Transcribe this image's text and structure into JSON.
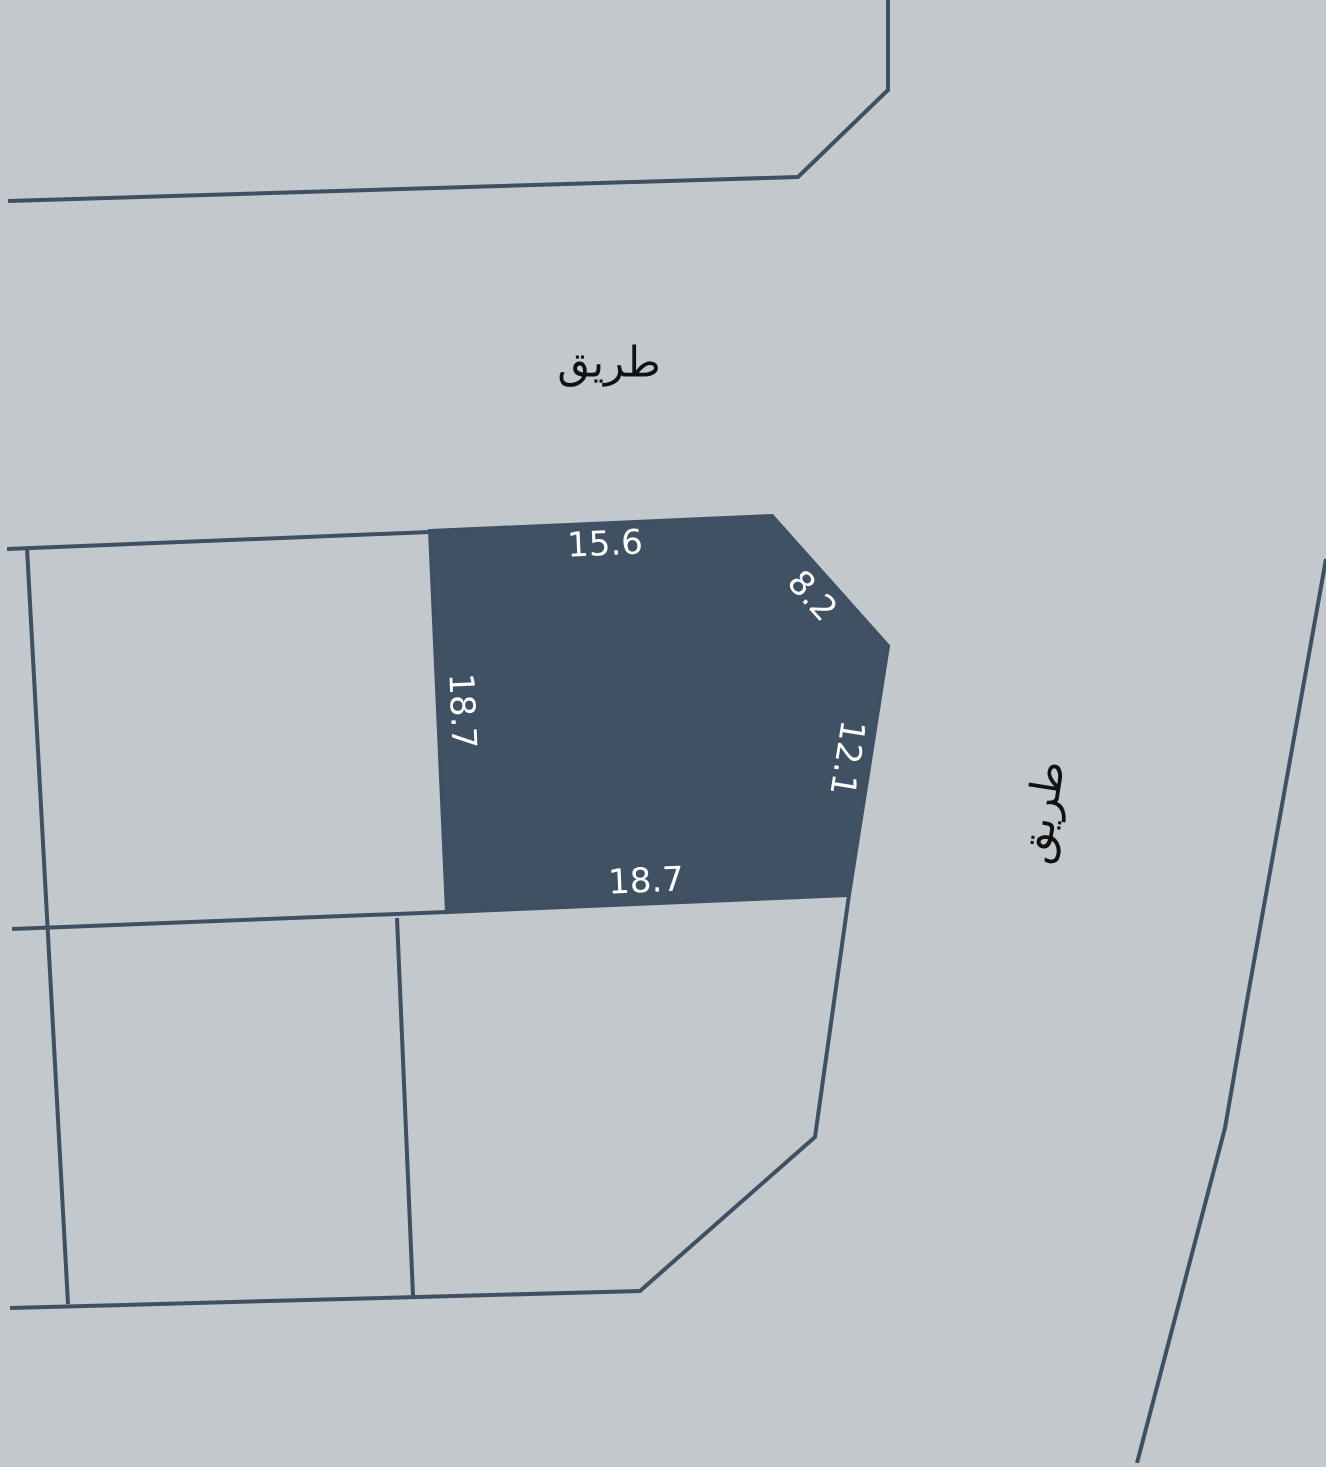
{
  "map": {
    "road_label_top": "طريق",
    "road_label_right": "طريق",
    "parcel": {
      "dimensions": {
        "top": "15.6",
        "top_right": "8.2",
        "left": "18.7",
        "right": "12.1",
        "bottom": "18.7"
      }
    },
    "colors": {
      "background": "#c3c8cc",
      "parcel_fill": "#415164",
      "boundary_line": "#3e5063",
      "dimension_text": "#ffffff",
      "road_text": "#111111"
    }
  }
}
